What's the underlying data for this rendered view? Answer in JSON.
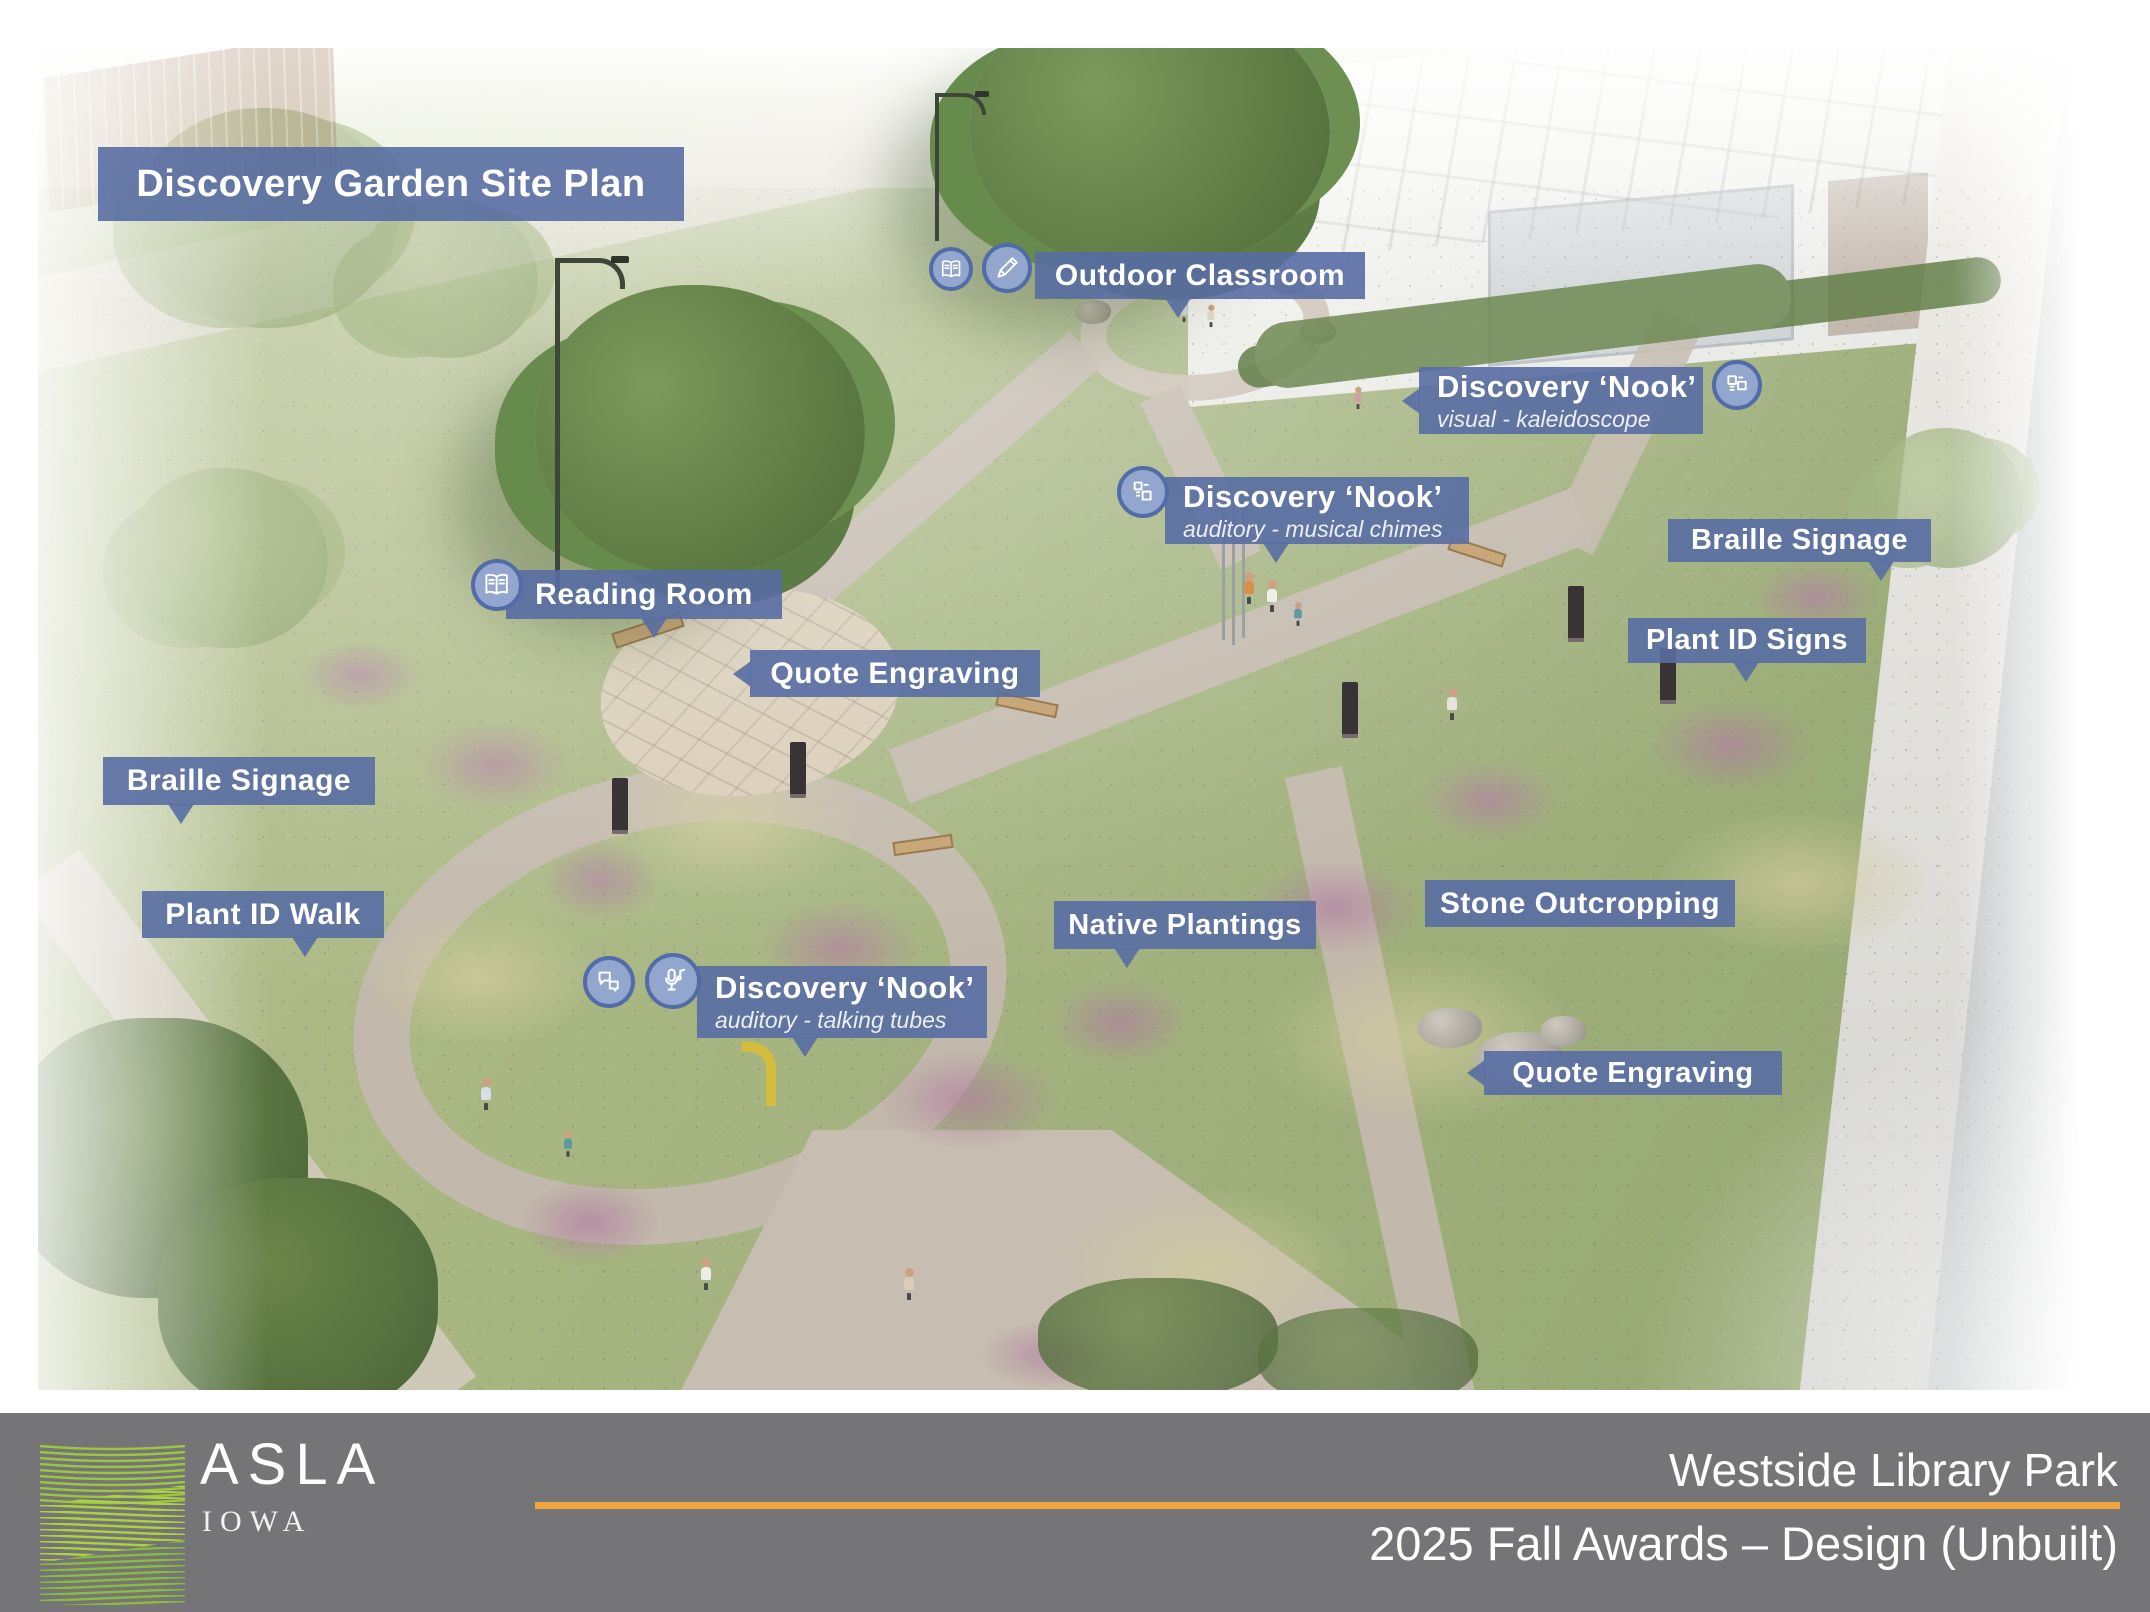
{
  "title_banner": {
    "text": "Discovery Garden Site Plan"
  },
  "callouts": [
    {
      "text": "Outdoor Classroom",
      "icons": [
        "book",
        "pencil"
      ]
    },
    {
      "text": "Discovery ‘Nook’",
      "subtitle": "visual - kaleidoscope",
      "icons": [
        "kaleidoscope"
      ]
    },
    {
      "text": "Discovery ‘Nook’",
      "subtitle": "auditory - musical chimes",
      "icons": [
        "chimes"
      ]
    },
    {
      "text": "Reading Room",
      "icons": [
        "book"
      ]
    },
    {
      "text": "Quote Engraving"
    },
    {
      "text": "Braille Signage"
    },
    {
      "text": "Plant ID Signs"
    },
    {
      "text": "Braille Signage"
    },
    {
      "text": "Plant ID Walk"
    },
    {
      "text": "Native Plantings"
    },
    {
      "text": "Stone Outcropping"
    },
    {
      "text": "Discovery ‘Nook’",
      "subtitle": "auditory - talking tubes",
      "icons": [
        "speech-bubbles",
        "microphone-music"
      ]
    },
    {
      "text": "Quote Engraving"
    }
  ],
  "footer": {
    "org": "ASLA",
    "chapter": "IOWA",
    "project": "Westside Library Park",
    "event": "2025 Fall Awards – Design (Unbuilt)"
  },
  "colors": {
    "callout_bg": "#586DA3",
    "callout_icon_fill": "#93A6CD",
    "callout_icon_ring": "#516CA6",
    "footer_bg": "#757477",
    "accent_rule": "#F2A43C",
    "logo_green": "#9AC43E"
  }
}
